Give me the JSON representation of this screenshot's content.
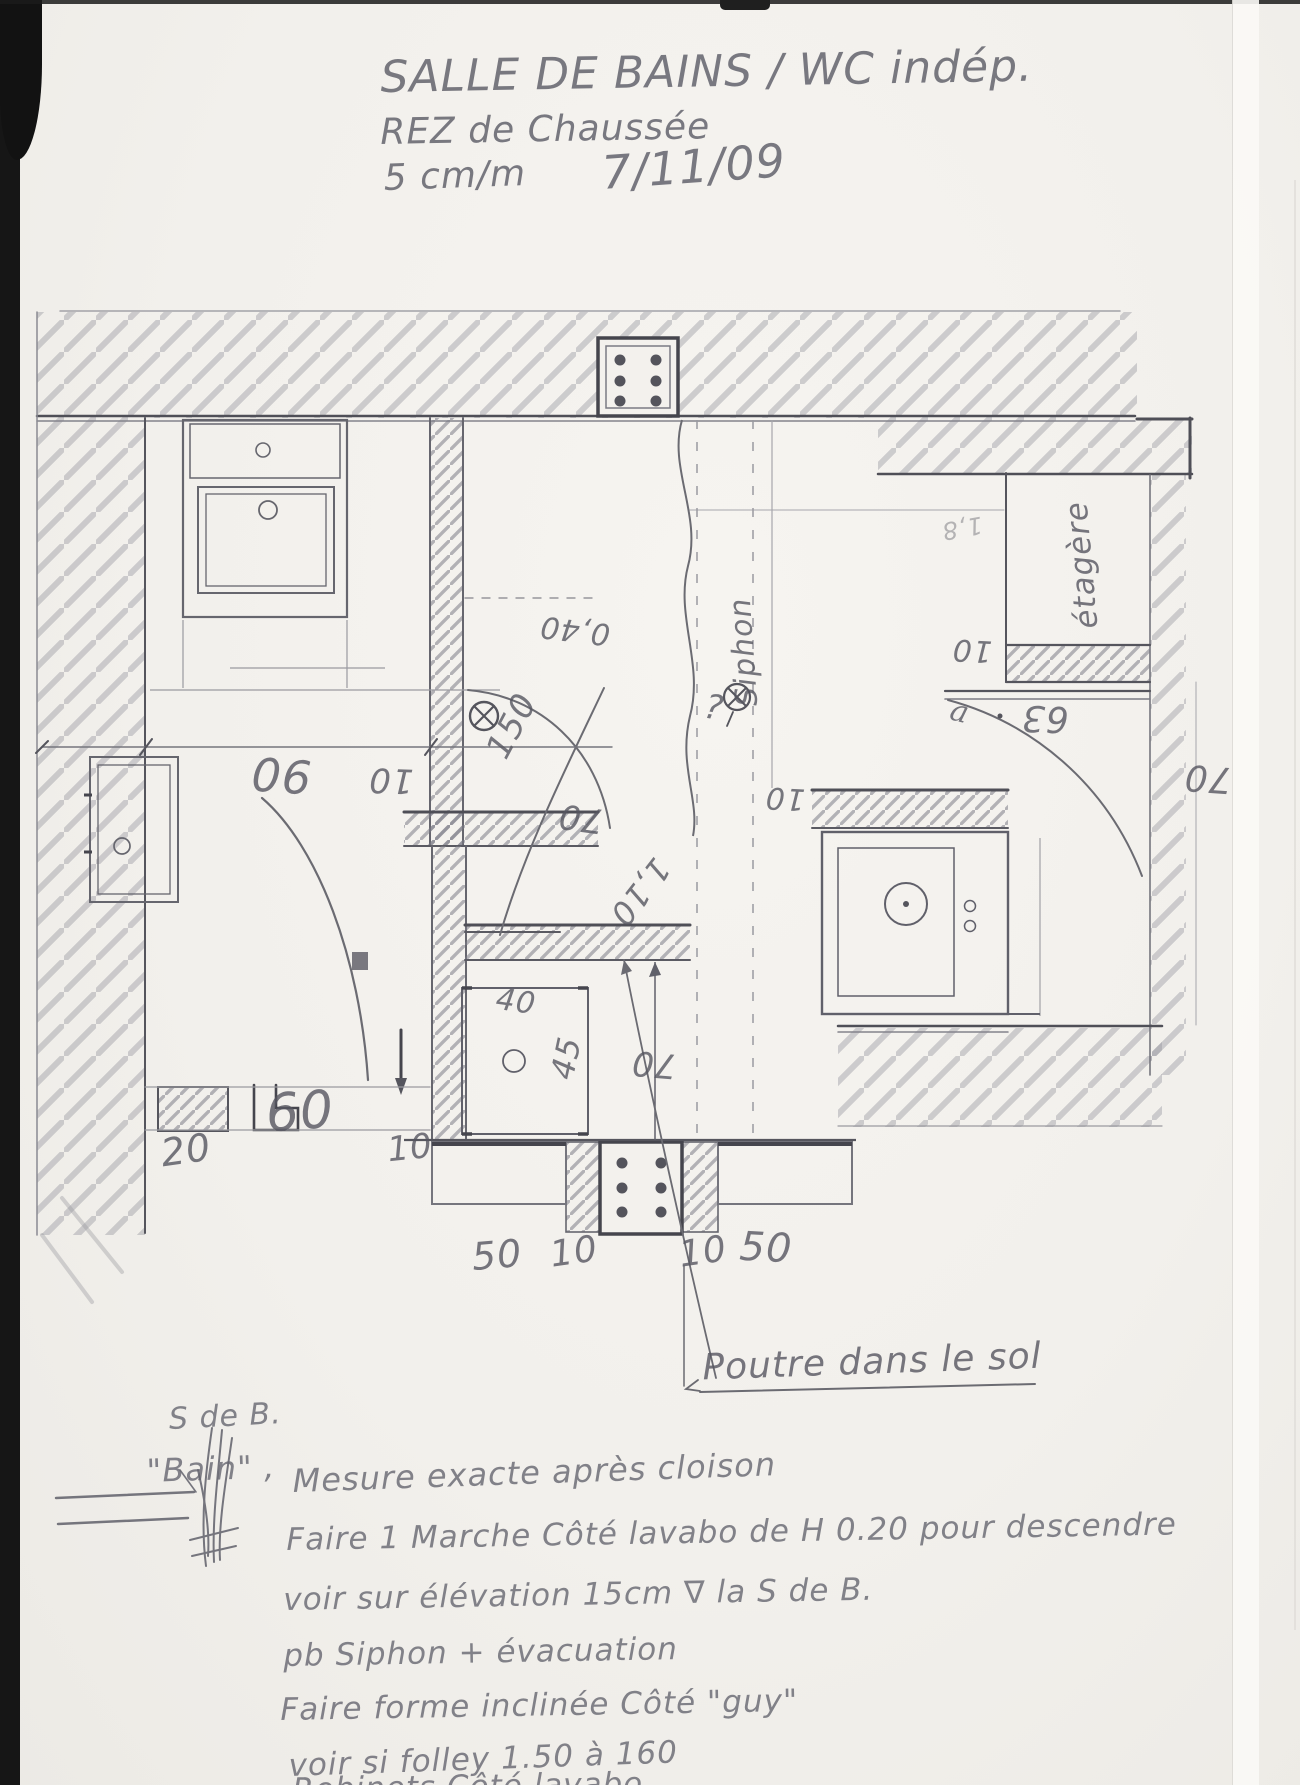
{
  "scan": {
    "paper_color": "#f2f0ec",
    "pencil_color": "#6e6e74",
    "edge_color": "#141414"
  },
  "title_block": {
    "line1": "SALLE DE BAINS / WC indép.",
    "line2": "REZ de Chaussée",
    "scale": "5 cm/m",
    "date": "7/11/09"
  },
  "plan": {
    "labels": [
      {
        "text": "0,40"
      },
      {
        "text": "150"
      },
      {
        "text": "90"
      },
      {
        "text": "10"
      },
      {
        "text": "70"
      },
      {
        "text": "1,10"
      },
      {
        "text": "Siphon"
      },
      {
        "text": "?"
      },
      {
        "text": "étagère"
      },
      {
        "text": "10"
      },
      {
        "text": "63"
      },
      {
        "text": "a"
      },
      {
        "text": "10"
      },
      {
        "text": "70"
      },
      {
        "text": "40"
      },
      {
        "text": "45"
      },
      {
        "text": "70"
      },
      {
        "text": "20"
      },
      {
        "text": "60"
      },
      {
        "text": "10"
      },
      {
        "text": "50"
      },
      {
        "text": "10"
      },
      {
        "text": "10"
      },
      {
        "text": "50"
      },
      {
        "text": "Poutre dans le sol"
      },
      {
        "text": "1,8"
      }
    ]
  },
  "notes": {
    "lines": [
      "S de B.",
      "\"Bain\" ,",
      "Mesure exacte après cloison",
      "Faire 1 Marche Côté lavabo de H 0.20 pour descendre",
      "voir sur élévation 15cm ∇ la S de B.",
      "pb Siphon + évacuation",
      "Faire forme inclinée Côté \"guy\"",
      "voir si folley 1.50 à 160",
      "Robinets Côté lavabo"
    ]
  }
}
